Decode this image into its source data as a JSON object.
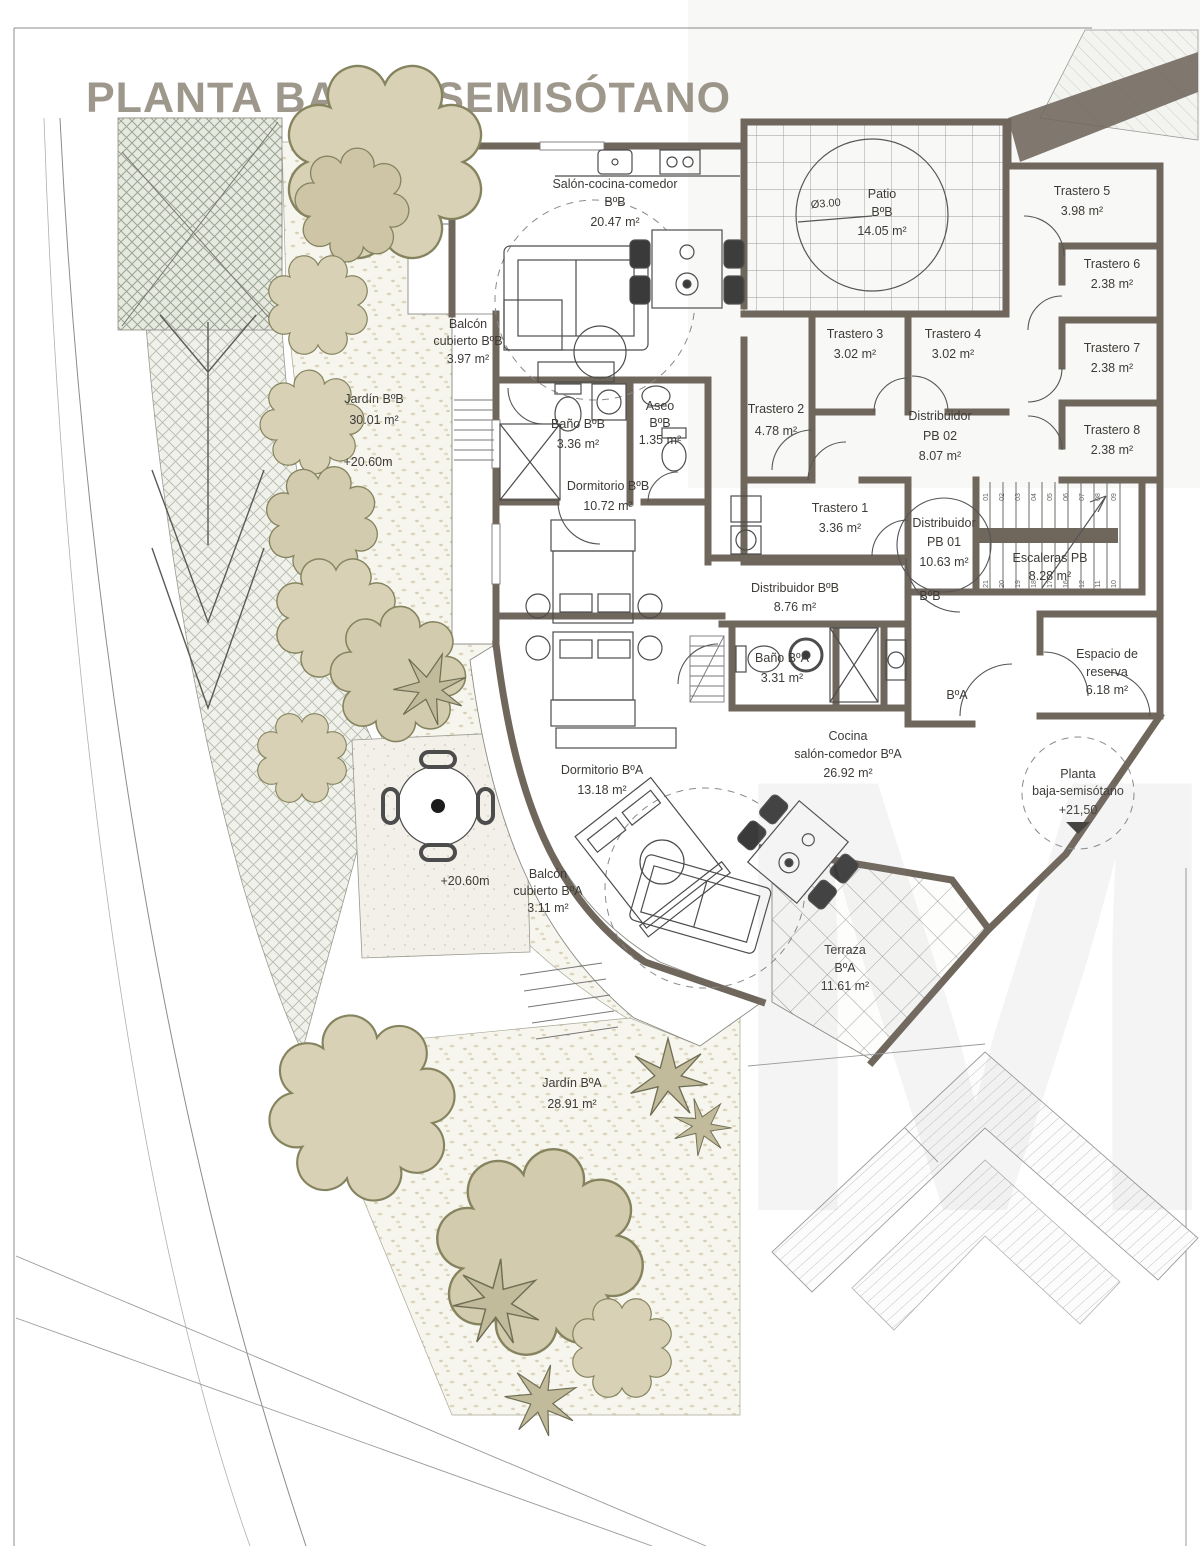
{
  "title": "PLANTA BAJA - SEMISÓTANO",
  "watermark": "M",
  "unit_tags": {
    "bb": "BºB",
    "ba": "BºA"
  },
  "site": {
    "level_garden_bb": "+20.60m",
    "level_patio_table": "+20.60m"
  },
  "rooms": {
    "salon_bb": {
      "name": "Salón-cocina-comedor",
      "unit": "BºB",
      "area": "20.47 m²"
    },
    "patio": {
      "name": "Patio",
      "unit": "BºB",
      "area": "14.05 m²",
      "diameter": "Ø3.00"
    },
    "trastero5": {
      "name": "Trastero 5",
      "area": "3.98 m²"
    },
    "trastero6": {
      "name": "Trastero 6",
      "area": "2.38 m²"
    },
    "trastero7": {
      "name": "Trastero 7",
      "area": "2.38 m²"
    },
    "trastero8": {
      "name": "Trastero 8",
      "area": "2.38 m²"
    },
    "trastero3": {
      "name": "Trastero 3",
      "area": "3.02 m²"
    },
    "trastero4": {
      "name": "Trastero 4",
      "area": "3.02 m²"
    },
    "trastero2": {
      "name": "Trastero 2",
      "area": "4.78 m²"
    },
    "distribuidor_pb02": {
      "name": "Distribuidor",
      "unit": "PB 02",
      "area": "8.07 m²"
    },
    "trastero1": {
      "name": "Trastero 1",
      "area": "3.36 m²"
    },
    "distribuidor_pb01": {
      "name": "Distribuidor",
      "unit": "PB 01",
      "area": "10.63 m²"
    },
    "escaleras": {
      "name": "Escaleras PB",
      "area": "8.28 m²"
    },
    "balcon_bb": {
      "name": "Balcón",
      "name2": "cubierto BºB",
      "area": "3.97 m²"
    },
    "jardin_bb": {
      "name": "Jardín BºB",
      "area": "30.01 m²"
    },
    "bano_bb": {
      "name": "Baño BºB",
      "area": "3.36 m²"
    },
    "aseo": {
      "name": "Aseo",
      "unit": "BºB",
      "area": "1.35 m²"
    },
    "dormitorio_bb": {
      "name": "Dormitorio BºB",
      "area": "10.72 m²"
    },
    "distribuidor_bb": {
      "name": "Distribuidor BºB",
      "area": "8.76 m²"
    },
    "bano_ba": {
      "name": "Baño BºA",
      "area": "3.31 m²"
    },
    "cocina_ba": {
      "name": "Cocina",
      "name2": "salón-comedor BºA",
      "area": "26.92 m²"
    },
    "espacio_reserva": {
      "name": "Espacio de",
      "name2": "reserva",
      "area": "6.18 m²"
    },
    "dormitorio_ba": {
      "name": "Dormitorio BºA",
      "area": "13.18 m²"
    },
    "balcon_ba": {
      "name": "Balcón",
      "name2": "cubierto BºA",
      "area": "3.11 m²"
    },
    "entrada": {
      "name": "Planta",
      "name2": "baja-semisótano",
      "level": "+21,50"
    },
    "terraza": {
      "name": "Terraza",
      "unit": "BºA",
      "area": "11.61 m²"
    },
    "jardin_ba": {
      "name": "Jardín BºA",
      "area": "28.91 m²"
    }
  },
  "stairs": {
    "steps_top": [
      "01",
      "02",
      "03",
      "04",
      "05",
      "06",
      "07",
      "08",
      "09"
    ],
    "steps_bottom": [
      "21",
      "20",
      "19",
      "18",
      "17",
      "16",
      "12",
      "11",
      "10"
    ]
  },
  "colors": {
    "wall": "#6f665c",
    "title": "#9e978c",
    "tree": "#d8d1b6",
    "hatch": "#b7bcae"
  }
}
